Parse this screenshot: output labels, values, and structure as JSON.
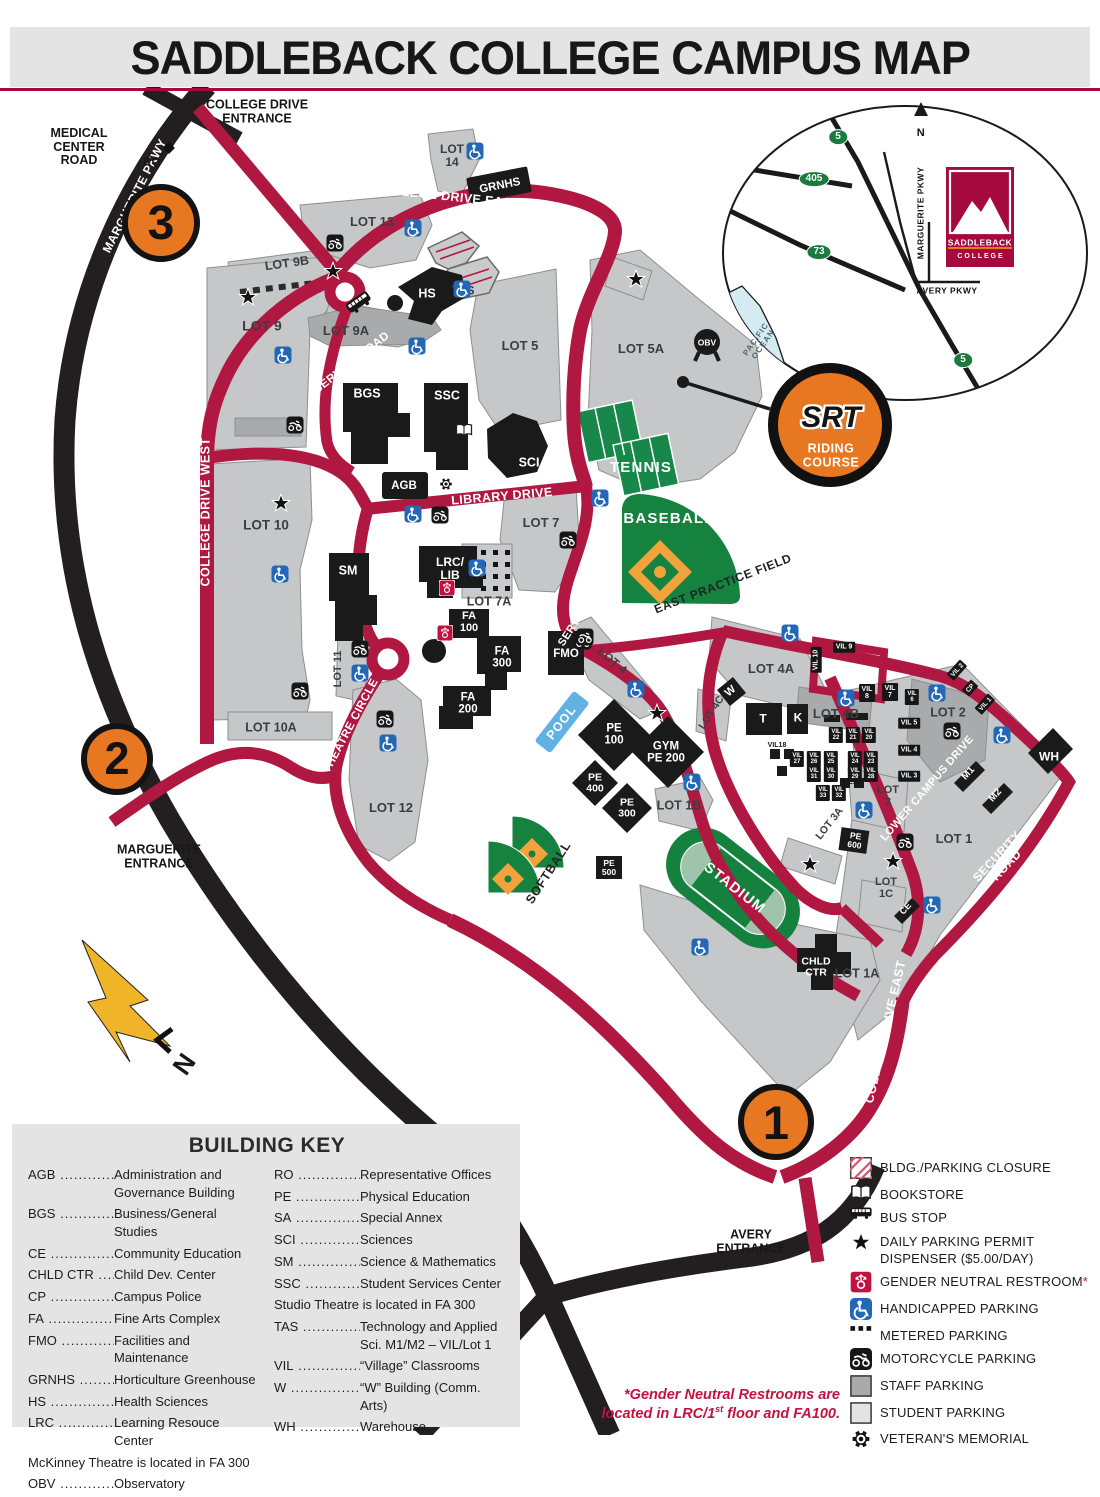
{
  "title": "SADDLEBACK COLLEGE CAMPUS MAP",
  "colors": {
    "road_red": "#b01842",
    "road_black": "#231f20",
    "student_parking": "#c6c7c9",
    "staff_parking": "#a9aaac",
    "building": "#1a1a1a",
    "field_green": "#15823f",
    "accent_orange": "#e87722",
    "brand_red": "#a6093d",
    "pool_blue": "#62b1e5",
    "handicap_blue": "#2368b6",
    "gnr_red": "#c41240",
    "shield_green": "#1b7a3d"
  },
  "map": {
    "road_labels": [
      {
        "t": "MARGUERITE PKWY",
        "x": 135,
        "y": 196,
        "r": -63,
        "s": 12
      },
      {
        "t": "COLLEGE DRIVE EAST",
        "x": 447,
        "y": 197,
        "r": 6,
        "s": 12.5
      },
      {
        "t": "COLLEGE DRIVE WEST",
        "x": 206,
        "y": 512,
        "r": -90,
        "s": 12.5
      },
      {
        "t": "SERVICE ROAD",
        "x": 352,
        "y": 363,
        "r": -38,
        "s": 11.5
      },
      {
        "t": "LIBRARY DRIVE",
        "x": 502,
        "y": 497,
        "r": -5,
        "s": 12.5
      },
      {
        "t": "SERVICE RD",
        "x": 581,
        "y": 616,
        "r": -57,
        "s": 11
      },
      {
        "t": "SERVICE ROAD",
        "x": 888,
        "y": 633,
        "r": 9,
        "s": 11.5
      },
      {
        "t": "THEATRE CIRCLE",
        "x": 351,
        "y": 726,
        "r": -62,
        "s": 11.5
      },
      {
        "t": "LOWER CAMPUS DRIVE",
        "x": 928,
        "y": 789,
        "r": -49,
        "s": 11
      },
      {
        "t": "SECURITY ROAD",
        "x": 1002,
        "y": 861,
        "r": -47,
        "s": 12
      },
      {
        "t": "COLLEGE DRIVE EAST",
        "x": 886,
        "y": 1032,
        "r": -77,
        "s": 12.5
      },
      {
        "t": "COLLEGE DRIVE WEST",
        "x": 644,
        "y": 1108,
        "r": 42,
        "s": 12.5
      },
      {
        "t": "MARGUERITE PKWY",
        "x": 200,
        "y": 1002,
        "r": 44,
        "s": 12.5
      },
      {
        "t": "AVERY PKWY",
        "x": 624,
        "y": 1303,
        "r": -16,
        "s": 12.5
      }
    ],
    "lot_labels": [
      {
        "t": "LOT 9B",
        "x": 287,
        "y": 264,
        "r": -8,
        "s": 12.5
      },
      {
        "t": "LOT 9",
        "x": 262,
        "y": 326,
        "s": 14
      },
      {
        "t": "LOT 9A",
        "x": 346,
        "y": 331,
        "s": 13
      },
      {
        "t": "LOT 13",
        "x": 372,
        "y": 222,
        "s": 13
      },
      {
        "t": "LOT\n14",
        "x": 452,
        "y": 156,
        "s": 12
      },
      {
        "t": "LOT 5",
        "x": 520,
        "y": 346,
        "s": 13
      },
      {
        "t": "LOT 5A",
        "x": 641,
        "y": 349,
        "s": 13
      },
      {
        "t": "LOT 7",
        "x": 541,
        "y": 523,
        "s": 13
      },
      {
        "t": "LOT 7A",
        "x": 489,
        "y": 602,
        "s": 12.5
      },
      {
        "t": "LOT 10",
        "x": 266,
        "y": 526,
        "s": 13.5
      },
      {
        "t": "LOT 10A",
        "x": 271,
        "y": 728,
        "s": 12.5
      },
      {
        "t": "LOT 11",
        "x": 339,
        "y": 669,
        "r": -90,
        "s": 11
      },
      {
        "t": "LOT 12",
        "x": 391,
        "y": 808,
        "s": 13
      },
      {
        "t": "LOT 4",
        "x": 612,
        "y": 661,
        "r": 40,
        "s": 12
      },
      {
        "t": "LOT 4A",
        "x": 771,
        "y": 669,
        "s": 13
      },
      {
        "t": "LOT 4B",
        "x": 836,
        "y": 714,
        "s": 13
      },
      {
        "t": "LOT 4C",
        "x": 712,
        "y": 713,
        "r": -57,
        "s": 10.5
      },
      {
        "t": "LOT 2",
        "x": 948,
        "y": 713,
        "s": 12.5
      },
      {
        "t": "LOT\n3",
        "x": 888,
        "y": 797,
        "s": 11
      },
      {
        "t": "LOT 3A",
        "x": 830,
        "y": 824,
        "r": -52,
        "s": 10.5
      },
      {
        "t": "LOT 1",
        "x": 954,
        "y": 839,
        "s": 13
      },
      {
        "t": "LOT 1A",
        "x": 857,
        "y": 974,
        "s": 12.5
      },
      {
        "t": "LOT 1B",
        "x": 679,
        "y": 806,
        "s": 12.5
      },
      {
        "t": "LOT\n1C",
        "x": 886,
        "y": 889,
        "s": 11
      },
      {
        "t": "TAS",
        "x": 463,
        "y": 291,
        "s": 12
      }
    ],
    "building_labels": [
      {
        "t": "BGS",
        "x": 367,
        "y": 394,
        "s": 12.5
      },
      {
        "t": "SSC",
        "x": 447,
        "y": 396,
        "s": 12.5
      },
      {
        "t": "SCI",
        "x": 529,
        "y": 463,
        "s": 12.5
      },
      {
        "t": "HS",
        "x": 427,
        "y": 294,
        "s": 12.5
      },
      {
        "t": "SM",
        "x": 348,
        "y": 571,
        "s": 12.5
      },
      {
        "t": "LRC/\nLIB",
        "x": 450,
        "y": 569,
        "s": 12
      },
      {
        "t": "AGB",
        "x": 404,
        "y": 486,
        "s": 11.5
      },
      {
        "t": "GRNHS",
        "x": 500,
        "y": 186,
        "r": -11,
        "s": 11.5
      },
      {
        "t": "FA\n100",
        "x": 469,
        "y": 623,
        "s": 11
      },
      {
        "t": "FA\n300",
        "x": 502,
        "y": 658,
        "s": 11.5
      },
      {
        "t": "FA\n200",
        "x": 468,
        "y": 704,
        "s": 11.5
      },
      {
        "t": "FMO",
        "x": 566,
        "y": 654,
        "s": 11.5
      },
      {
        "t": "PE\n100",
        "x": 614,
        "y": 735,
        "s": 11.5
      },
      {
        "t": "GYM\nPE 200",
        "x": 666,
        "y": 753,
        "s": 11.5
      },
      {
        "t": "PE\n400",
        "x": 595,
        "y": 784,
        "s": 10.5
      },
      {
        "t": "PE\n300",
        "x": 627,
        "y": 809,
        "s": 10.5
      },
      {
        "t": "PE\n500",
        "x": 609,
        "y": 868,
        "s": 8.5
      },
      {
        "t": "PE\n600",
        "x": 855,
        "y": 841,
        "r": 8,
        "s": 8.5
      },
      {
        "t": "CHLD\nCTR",
        "x": 816,
        "y": 968,
        "s": 10.5
      },
      {
        "t": "T",
        "x": 763,
        "y": 719,
        "s": 12
      },
      {
        "t": "K",
        "x": 798,
        "y": 718,
        "s": 12
      },
      {
        "t": "W",
        "x": 731,
        "y": 692,
        "r": -40,
        "s": 11
      },
      {
        "t": "WH",
        "x": 1049,
        "y": 757,
        "s": 12
      },
      {
        "t": "M1",
        "x": 969,
        "y": 774,
        "r": -48,
        "s": 10
      },
      {
        "t": "M2",
        "x": 996,
        "y": 796,
        "r": -48,
        "s": 10
      },
      {
        "t": "CE",
        "x": 906,
        "y": 909,
        "r": -48,
        "s": 9
      },
      {
        "t": "OBV",
        "x": 707,
        "y": 343,
        "s": 8.5
      }
    ],
    "village_labels": [
      {
        "t": "VIL 10",
        "x": 816,
        "y": 660,
        "r": -90,
        "s": 7
      },
      {
        "t": "VIL 9",
        "x": 844,
        "y": 647,
        "s": 7
      },
      {
        "t": "VIL\n8",
        "x": 867,
        "y": 693,
        "s": 7
      },
      {
        "t": "VIL\n7",
        "x": 890,
        "y": 692,
        "s": 7
      },
      {
        "t": "VIL\n6",
        "x": 912,
        "y": 697,
        "s": 6
      },
      {
        "t": "VIL 5",
        "x": 909,
        "y": 723,
        "s": 7
      },
      {
        "t": "VIL 4",
        "x": 909,
        "y": 750,
        "s": 7
      },
      {
        "t": "VIL 3",
        "x": 909,
        "y": 776,
        "s": 7
      },
      {
        "t": "VIL 2",
        "x": 957,
        "y": 670,
        "r": -48,
        "s": 6.5
      },
      {
        "t": "CP",
        "x": 970,
        "y": 688,
        "r": -48,
        "s": 6.5
      },
      {
        "t": "VIL 1",
        "x": 985,
        "y": 704,
        "r": -48,
        "s": 6.5
      },
      {
        "t": "VIL\n22",
        "x": 836,
        "y": 735,
        "s": 6
      },
      {
        "t": "VIL\n21",
        "x": 853,
        "y": 735,
        "s": 6
      },
      {
        "t": "VIL\n20",
        "x": 869,
        "y": 735,
        "s": 6
      },
      {
        "t": "VIL\n27",
        "x": 797,
        "y": 759,
        "s": 6
      },
      {
        "t": "VIL\n26",
        "x": 814,
        "y": 759,
        "s": 6
      },
      {
        "t": "VIL\n25",
        "x": 831,
        "y": 759,
        "s": 6
      },
      {
        "t": "VIL\n24",
        "x": 855,
        "y": 759,
        "s": 6
      },
      {
        "t": "VIL\n23",
        "x": 871,
        "y": 759,
        "s": 6
      },
      {
        "t": "VIL\n31",
        "x": 814,
        "y": 774,
        "s": 6
      },
      {
        "t": "VIL\n30",
        "x": 831,
        "y": 774,
        "s": 6
      },
      {
        "t": "VIL\n29",
        "x": 855,
        "y": 774,
        "s": 6
      },
      {
        "t": "VIL\n28",
        "x": 871,
        "y": 774,
        "s": 6
      },
      {
        "t": "VIL\n33",
        "x": 823,
        "y": 793,
        "s": 6
      },
      {
        "t": "VIL\n32",
        "x": 839,
        "y": 793,
        "s": 6
      }
    ],
    "field_labels": [
      {
        "t": "TENNIS",
        "x": 641,
        "y": 468,
        "s": 15,
        "c": "fld-w"
      },
      {
        "t": "BASEBALL",
        "x": 669,
        "y": 519,
        "s": 15,
        "c": "fld-w"
      },
      {
        "t": "STADIUM",
        "x": 734,
        "y": 889,
        "r": 38,
        "s": 14.5,
        "c": "fld-w"
      },
      {
        "t": "SOFTBALL",
        "x": 549,
        "y": 873,
        "r": -57,
        "s": 12.5,
        "c": "fld-b"
      },
      {
        "t": "EAST PRACTICE FIELD",
        "x": 723,
        "y": 584,
        "r": -21,
        "s": 12,
        "c": "fld-b"
      },
      {
        "t": "POOL",
        "x": 562,
        "y": 723,
        "r": -52,
        "s": 12.5,
        "c": "pool-lbl"
      }
    ],
    "misc_labels": [
      {
        "t": "COLLEGE DRIVE\nENTRANCE",
        "x": 257,
        "y": 112,
        "s": 12.5,
        "c": "blk"
      },
      {
        "t": "MEDICAL\nCENTER\nROAD",
        "x": 79,
        "y": 147,
        "s": 12.5,
        "c": "blk"
      },
      {
        "t": "RO",
        "x": 152,
        "y": 163,
        "s": 11.5,
        "c": "blk"
      },
      {
        "t": "MARGUERITE\nENTRANCE",
        "x": 159,
        "y": 857,
        "s": 12.5,
        "c": "blk"
      },
      {
        "t": "AVERY\nENTRANCE",
        "x": 751,
        "y": 1242,
        "s": 12.5,
        "c": "blk"
      },
      {
        "t": "VIL18",
        "x": 777,
        "y": 746,
        "s": 7,
        "c": "tiny"
      },
      {
        "t": "VIL19",
        "x": 851,
        "y": 783,
        "s": 7,
        "c": "tiny"
      },
      {
        "t": "N",
        "x": 184,
        "y": 1064,
        "r": -55,
        "s": 26,
        "c": "blk"
      }
    ],
    "inset_labels": [
      {
        "t": "5",
        "x": 838,
        "y": 137,
        "s": 10,
        "c": "shield"
      },
      {
        "t": "405",
        "x": 814,
        "y": 179,
        "s": 10,
        "c": "shield"
      },
      {
        "t": "73",
        "x": 819,
        "y": 252,
        "s": 10,
        "c": "shield"
      },
      {
        "t": "5",
        "x": 963,
        "y": 360,
        "s": 10,
        "c": "shield"
      },
      {
        "t": "MARGUERITE PKWY",
        "x": 921,
        "y": 213,
        "r": -90,
        "s": 8.5,
        "c": "inset-b"
      },
      {
        "t": "AVERY PKWY",
        "x": 947,
        "y": 291,
        "s": 8.5,
        "c": "inset-b"
      },
      {
        "t": "N",
        "x": 921,
        "y": 134,
        "s": 11,
        "c": "inset-b"
      },
      {
        "t": "PACIFIC\nOCEAN",
        "x": 760,
        "y": 342,
        "r": -55,
        "s": 8,
        "c": "inset-o"
      },
      {
        "t": "SADDLEBACK",
        "x": 980,
        "y": 243,
        "s": 8.5,
        "c": "logo-t"
      },
      {
        "t": "C O L L E G E",
        "x": 980,
        "y": 257,
        "s": 7,
        "c": "logo-c"
      }
    ],
    "srt": [
      {
        "t": "SRT",
        "x": 831,
        "y": 418,
        "s": 30,
        "c": "srt-t"
      },
      {
        "t": "RIDING\nCOURSE",
        "x": 831,
        "y": 456,
        "s": 12.5,
        "c": "srt-s"
      }
    ],
    "icons": [
      {
        "k": "hc",
        "x": 283,
        "y": 355
      },
      {
        "k": "hc",
        "x": 475,
        "y": 151
      },
      {
        "k": "hc",
        "x": 413,
        "y": 228
      },
      {
        "k": "hc",
        "x": 462,
        "y": 289
      },
      {
        "k": "hc",
        "x": 417,
        "y": 346
      },
      {
        "k": "hc",
        "x": 280,
        "y": 574
      },
      {
        "k": "hc",
        "x": 360,
        "y": 673
      },
      {
        "k": "hc",
        "x": 388,
        "y": 743
      },
      {
        "k": "hc",
        "x": 477,
        "y": 568
      },
      {
        "k": "hc",
        "x": 413,
        "y": 514
      },
      {
        "k": "hc",
        "x": 600,
        "y": 498
      },
      {
        "k": "hc",
        "x": 636,
        "y": 689
      },
      {
        "k": "hc",
        "x": 790,
        "y": 633
      },
      {
        "k": "hc",
        "x": 846,
        "y": 698
      },
      {
        "k": "hc",
        "x": 937,
        "y": 693
      },
      {
        "k": "hc",
        "x": 1002,
        "y": 735
      },
      {
        "k": "hc",
        "x": 864,
        "y": 810
      },
      {
        "k": "hc",
        "x": 692,
        "y": 782
      },
      {
        "k": "hc",
        "x": 700,
        "y": 947
      },
      {
        "k": "hc",
        "x": 932,
        "y": 905
      },
      {
        "k": "mc",
        "x": 335,
        "y": 243
      },
      {
        "k": "mc",
        "x": 295,
        "y": 425
      },
      {
        "k": "mc",
        "x": 568,
        "y": 540
      },
      {
        "k": "mc",
        "x": 583,
        "y": 641
      },
      {
        "k": "mc",
        "x": 440,
        "y": 515
      },
      {
        "k": "mc",
        "x": 360,
        "y": 649
      },
      {
        "k": "mc",
        "x": 300,
        "y": 691
      },
      {
        "k": "mc",
        "x": 385,
        "y": 719
      },
      {
        "k": "mc",
        "x": 585,
        "y": 637
      },
      {
        "k": "mc",
        "x": 952,
        "y": 731
      },
      {
        "k": "mc",
        "x": 905,
        "y": 842
      },
      {
        "k": "star",
        "x": 248,
        "y": 297
      },
      {
        "k": "star",
        "x": 281,
        "y": 503
      },
      {
        "k": "star",
        "x": 333,
        "y": 271
      },
      {
        "k": "star",
        "x": 636,
        "y": 279
      },
      {
        "k": "star",
        "x": 657,
        "y": 713
      },
      {
        "k": "star",
        "x": 810,
        "y": 864
      },
      {
        "k": "star",
        "x": 893,
        "y": 861
      },
      {
        "k": "gnr",
        "x": 447,
        "y": 588
      },
      {
        "k": "gnr",
        "x": 445,
        "y": 633
      },
      {
        "k": "bus",
        "x": 359,
        "y": 303,
        "r": -35
      },
      {
        "k": "book",
        "x": 464,
        "y": 430
      },
      {
        "k": "vet",
        "x": 446,
        "y": 484
      },
      {
        "k": "diamond",
        "x": 169,
        "y": 148
      }
    ],
    "markers": [
      {
        "t": "3",
        "x": 161,
        "y": 223,
        "d": 78
      },
      {
        "t": "2",
        "x": 117,
        "y": 759,
        "d": 72
      },
      {
        "t": "1",
        "x": 776,
        "y": 1122,
        "d": 76
      }
    ]
  },
  "building_key": {
    "title": "BUILDING KEY",
    "col1": [
      {
        "a": "AGB",
        "d": "Administration and Governance Building"
      },
      {
        "a": "BGS",
        "d": "Business/General Studies"
      },
      {
        "a": "CE",
        "d": "Community Education"
      },
      {
        "a": "CHLD CTR",
        "d": "Child Dev. Center"
      },
      {
        "a": "CP",
        "d": "Campus Police"
      },
      {
        "a": "FA",
        "d": "Fine Arts Complex"
      },
      {
        "a": "FMO",
        "d": "Facilities and Maintenance"
      },
      {
        "a": "GRNHS",
        "d": "Horticulture Greenhouse"
      },
      {
        "a": "HS",
        "d": "Health Sciences"
      },
      {
        "a": "LRC",
        "d": "Learning Resouce Center"
      },
      {
        "note": "McKinney Theatre is located in FA 300"
      },
      {
        "a": "OBV",
        "d": "Observatory"
      }
    ],
    "col2": [
      {
        "a": "RO",
        "d": "Representative Offices"
      },
      {
        "a": "PE",
        "d": "Physical Education"
      },
      {
        "a": "SA",
        "d": "Special Annex"
      },
      {
        "a": "SCI",
        "d": "Sciences"
      },
      {
        "a": "SM",
        "d": "Science & Mathematics"
      },
      {
        "a": "SSC",
        "d": "Student Services Center"
      },
      {
        "note": "Studio Theatre is located in FA 300"
      },
      {
        "a": "TAS",
        "d": "Technology and Applied Sci. M1/M2 – VIL/Lot 1"
      },
      {
        "a": "VIL",
        "d": "“Village” Classrooms"
      },
      {
        "a": "W",
        "d": "“W” Building (Comm. Arts)"
      },
      {
        "a": "WH",
        "d": "Warehouse"
      }
    ]
  },
  "legend": {
    "items": [
      {
        "icon": "closure",
        "label": "BLDG./PARKING CLOSURE"
      },
      {
        "icon": "book",
        "label": "BOOKSTORE"
      },
      {
        "icon": "bus",
        "label": "BUS STOP"
      },
      {
        "icon": "star",
        "label": "DAILY PARKING PERMIT\nDISPENSER ($5.00/DAY)"
      },
      {
        "icon": "gnr",
        "label": "GENDER NEUTRAL RESTROOM",
        "star": "*"
      },
      {
        "icon": "hc",
        "label": "HANDICAPPED PARKING"
      },
      {
        "icon": "metered",
        "label": "METERED PARKING"
      },
      {
        "icon": "mc",
        "label": "MOTORCYCLE PARKING"
      },
      {
        "icon": "staff",
        "label": "STAFF PARKING"
      },
      {
        "icon": "student",
        "label": "STUDENT PARKING"
      },
      {
        "icon": "vet",
        "label": "VETERAN'S MEMORIAL"
      }
    ],
    "note_line1": "*Gender Neutral Restrooms are",
    "note_line2a": "located in LRC/1",
    "note_sup": "st",
    "note_line2b": " floor and FA100."
  }
}
